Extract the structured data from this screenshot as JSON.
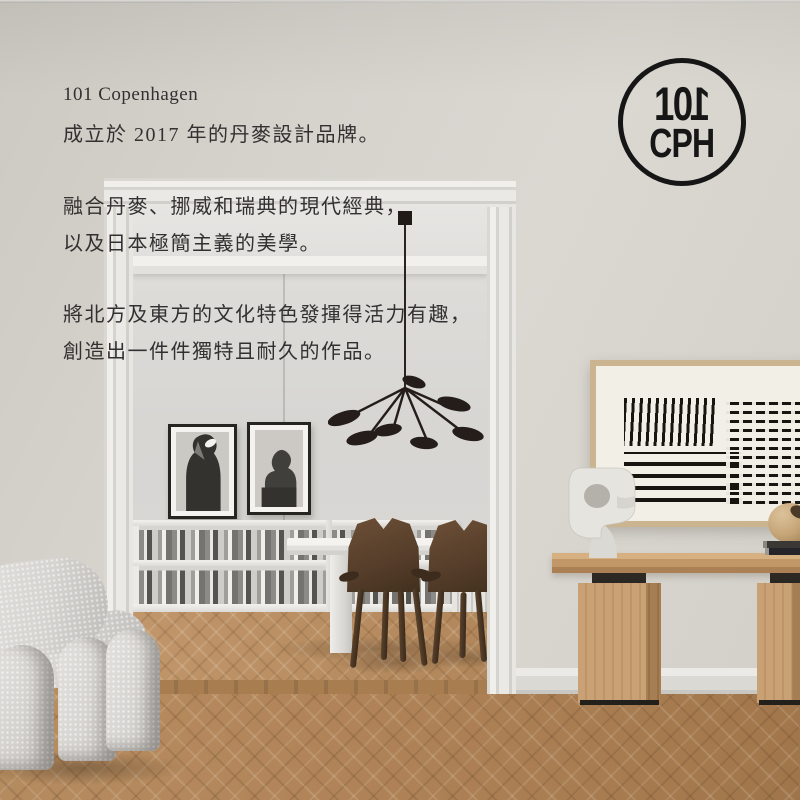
{
  "brand": {
    "name": "101 Copenhagen",
    "intro_lines": [
      "成立於 2017 年的丹麥設計品牌。",
      "融合丹麥、挪威和瑞典的現代經典，",
      "以及日本極簡主義的美學。",
      "將北方及東方的文化特色發揮得活力有趣，",
      "創造出一件件獨特且耐久的作品。"
    ]
  },
  "logo": {
    "numerals_left": "10",
    "numeral_flipped": "1",
    "letters": "CPH"
  },
  "colors": {
    "logo_ink": "#161616",
    "text": "#333031",
    "wall": "#d5d2cc",
    "inner_wall": "#d9d8d5",
    "floor_oak": "#b1865a",
    "console_oak": "#c29768",
    "walnut_chair": "#55402d",
    "boucle_fabric": "#d9d7d3",
    "art_ink": "#17150f"
  }
}
